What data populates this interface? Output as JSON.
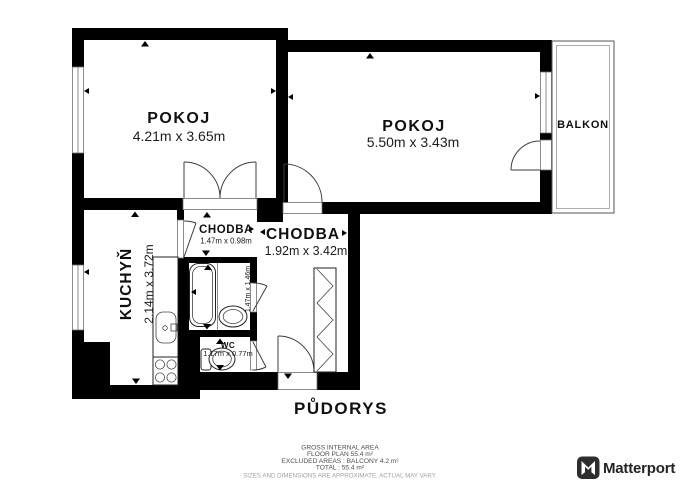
{
  "plan": {
    "title": "PŮDORYS",
    "rooms": {
      "pokoj1": {
        "name": "POKOJ",
        "dims": "4.21m x 3.65m"
      },
      "pokoj2": {
        "name": "POKOJ",
        "dims": "5.50m x 3.43m"
      },
      "balkon": {
        "name": "BALKON"
      },
      "chodba_small": {
        "name": "CHODBA",
        "dims": "1.47m x 0.98m"
      },
      "chodba_large": {
        "name": "CHODBA",
        "dims": "1.92m x 3.42m"
      },
      "kuchyn": {
        "name": "KUCHYŇ",
        "dims": "2.14m x 3.72m"
      },
      "koupelna": {
        "dims": "1.47m x 1.46m"
      },
      "wc": {
        "name": "WC",
        "dims": "1.17m x 0.77m"
      }
    }
  },
  "footer": {
    "area_lines": [
      "GROSS INTERNAL AREA",
      "FLOOR PLAN 55.4 m²",
      "EXCLUDED AREAS :  BALCONY 4.2 m²",
      "TOTAL :  55.4 m²"
    ],
    "disclaimer": "SIZES AND DIMENSIONS ARE APPROXIMATE, ACTUAL MAY VARY."
  },
  "branding": {
    "logo_text": "Matterport"
  },
  "colors": {
    "wall": "#000000",
    "floor": "#ffffff",
    "line": "#3c3c3c",
    "footer_text": "#4d4d4d",
    "disclaimer_text": "#a0a0a0",
    "logo_dark": "#2d2d2d"
  }
}
